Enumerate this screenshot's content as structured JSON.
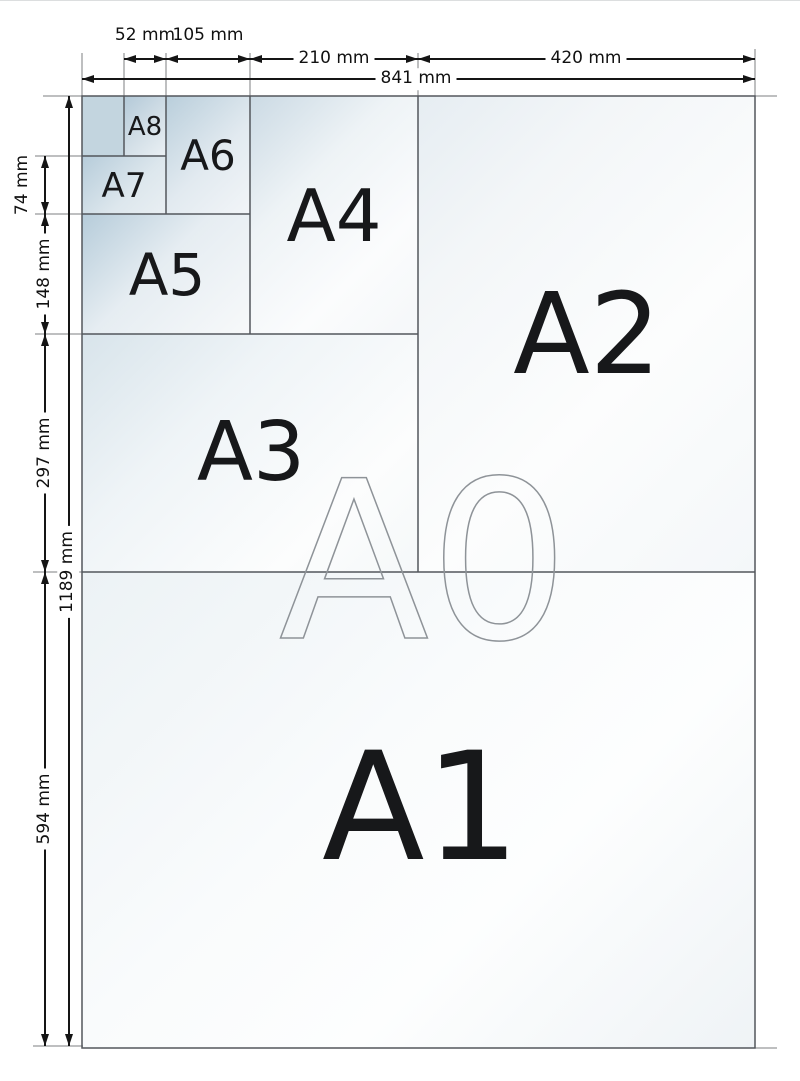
{
  "title": "A-series paper sizes diagram",
  "sheets": {
    "a0": "A0",
    "a1": "A1",
    "a2": "A2",
    "a3": "A3",
    "a4": "A4",
    "a5": "A5",
    "a6": "A6",
    "a7": "A7",
    "a8": "A8"
  },
  "dims": {
    "d52": "52 mm",
    "d105": "105 mm",
    "d210": "210 mm",
    "d420": "420 mm",
    "d841": "841 mm",
    "d74": "74 mm",
    "d148": "148 mm",
    "d297": "297 mm",
    "d594": "594 mm",
    "d1189": "1189 mm"
  },
  "colors": {
    "sheet_border": "#53575c",
    "extension_line": "#7c7f82",
    "dimension_line": "#151515",
    "sheet_fill_dark": "#b6ccda",
    "sheet_fill_light": "#fdfefe",
    "a0_outline": "#8e9398"
  }
}
